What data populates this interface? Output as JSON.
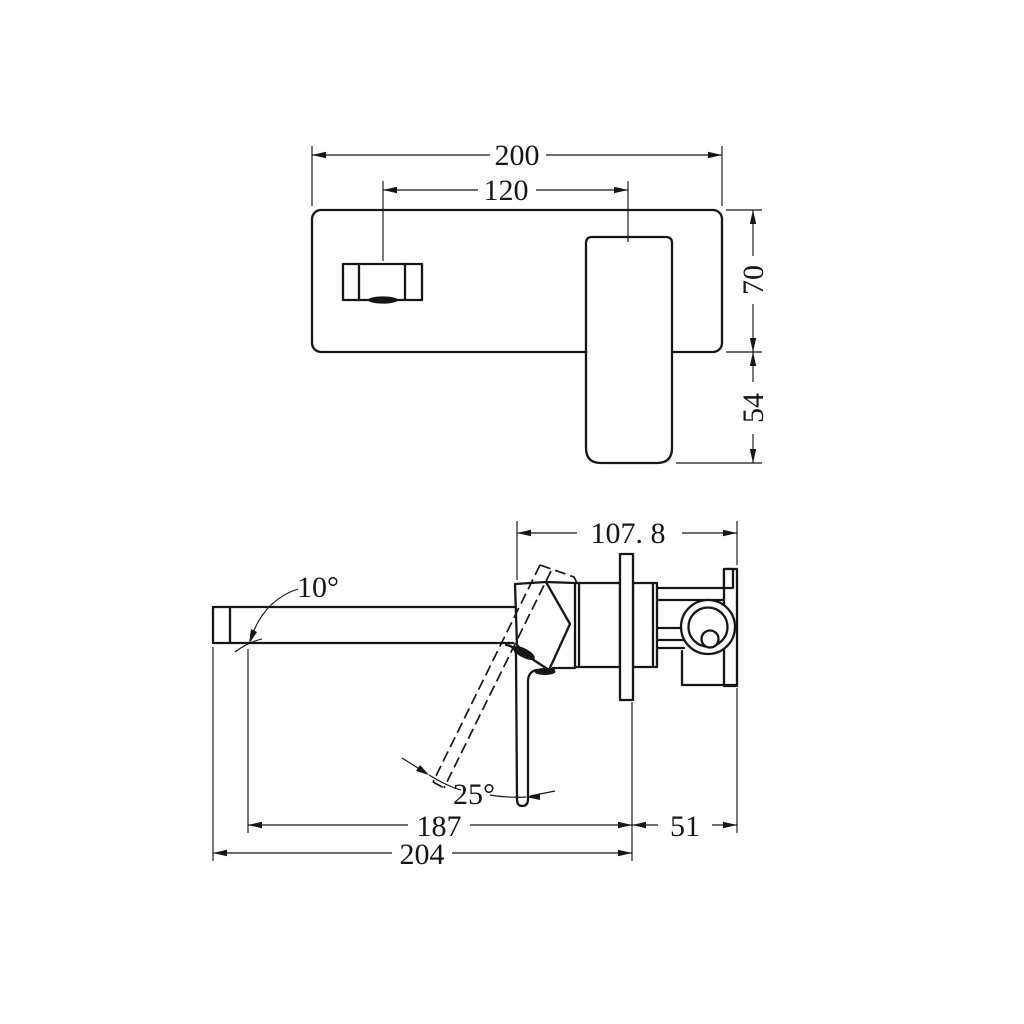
{
  "colors": {
    "ink": "#161616",
    "paper": "#ffffff"
  },
  "front_view": {
    "dimensions": {
      "plate_width": "200",
      "spout_to_handle": "120",
      "plate_height": "70",
      "handle_drop": "54"
    }
  },
  "side_view": {
    "dimensions": {
      "depth_overall": "107. 8",
      "spout_angle": "10°",
      "handle_swing": "25°",
      "outlet_to_plate": "187",
      "tip_to_plate": "204",
      "plate_to_wall": "51"
    }
  }
}
